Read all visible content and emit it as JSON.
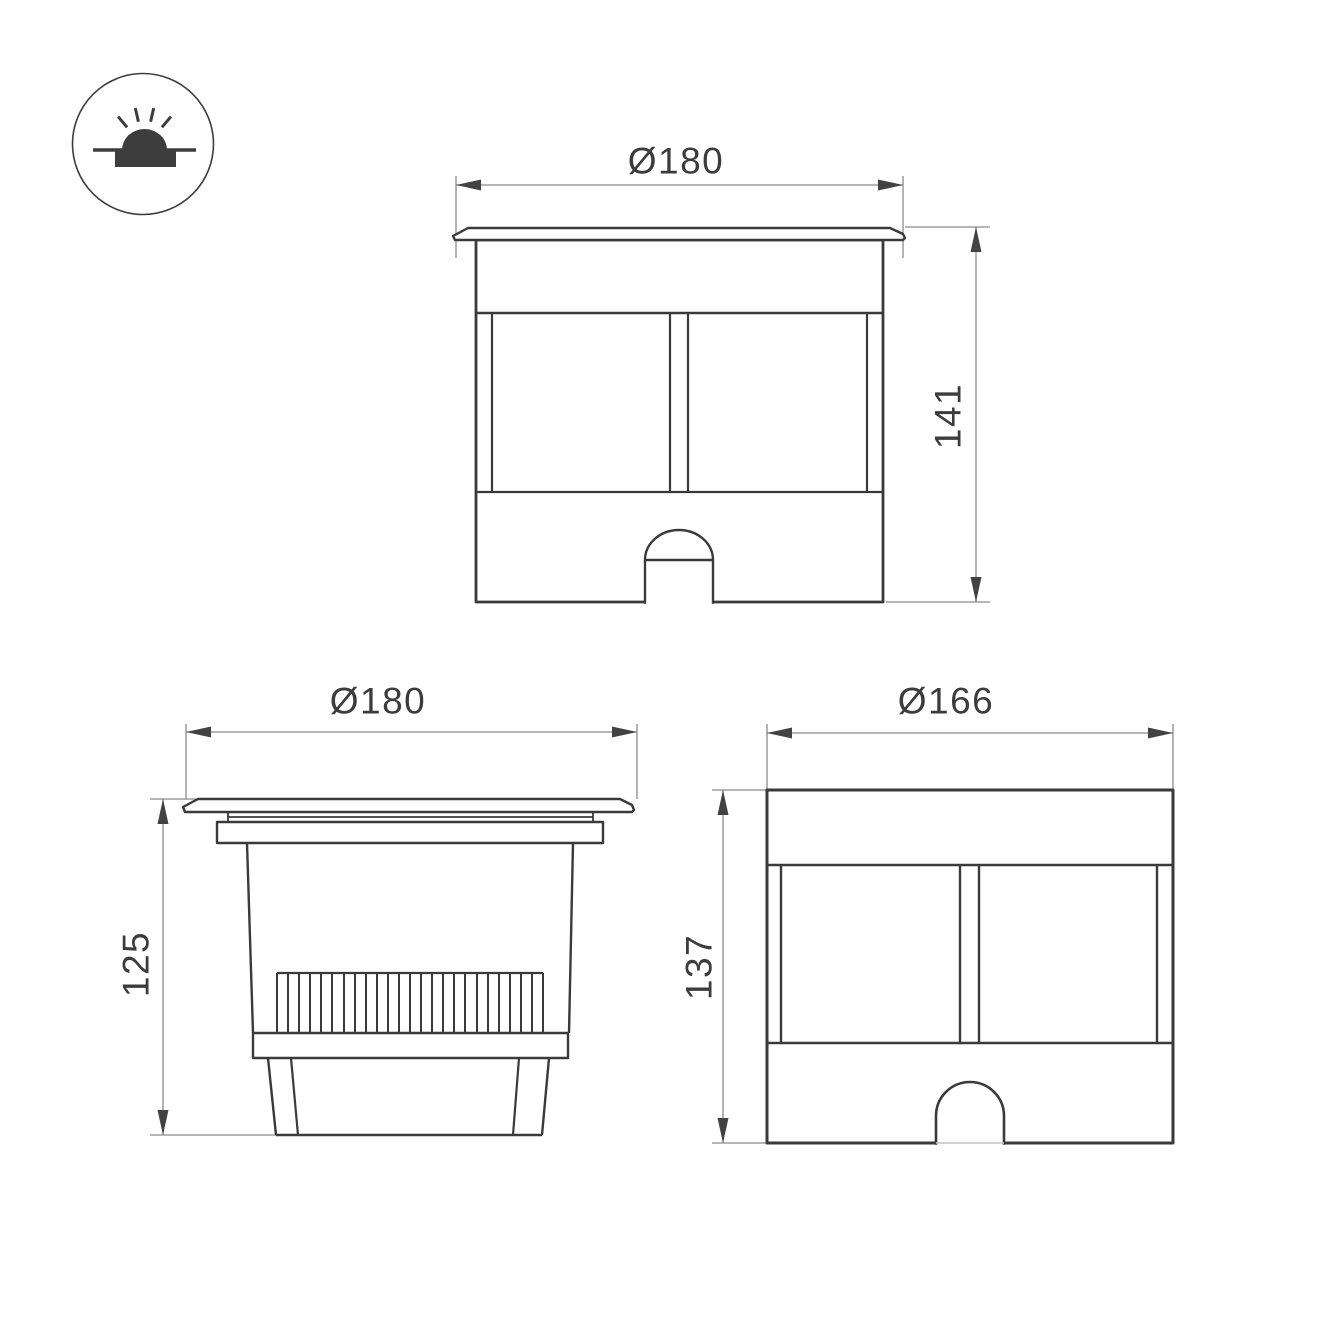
{
  "icon": {
    "name": "recessed-ground-light"
  },
  "views": {
    "front": {
      "diameter": "Ø180",
      "height": "141"
    },
    "section": {
      "diameter": "Ø180",
      "height": "125"
    },
    "side": {
      "diameter": "Ø166",
      "height": "137"
    }
  },
  "colors": {
    "line": "#3a3a3a",
    "dimension_line": "#8a8a8a",
    "text": "#3c3c3c",
    "background": "#ffffff"
  }
}
